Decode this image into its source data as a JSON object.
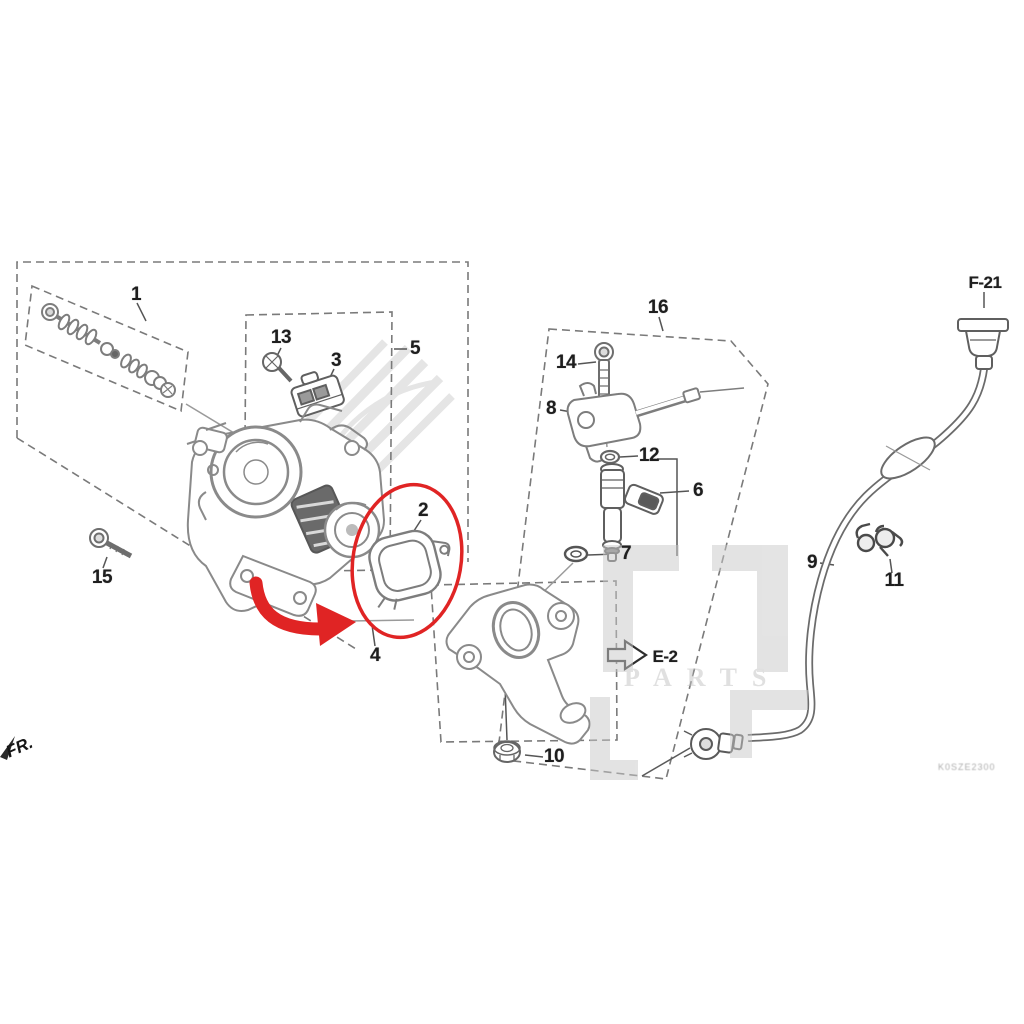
{
  "page": {
    "width": 1024,
    "height": 1024,
    "background": "#ffffff",
    "type": "exploded-parts-diagram",
    "subject": "throttle body / fuel injection assembly"
  },
  "colors": {
    "highlight_red": "#e02424",
    "line_gray": "#8a8a8a",
    "label_dark": "#1e1e1e",
    "watermark_gray": "#c9c9c9"
  },
  "part_labels": [
    {
      "text": "1",
      "x": 136,
      "y": 295
    },
    {
      "text": "2",
      "x": 423,
      "y": 511
    },
    {
      "text": "3",
      "x": 336,
      "y": 361
    },
    {
      "text": "4",
      "x": 375,
      "y": 656
    },
    {
      "text": "5",
      "x": 415,
      "y": 349
    },
    {
      "text": "6",
      "x": 698,
      "y": 491
    },
    {
      "text": "7",
      "x": 626,
      "y": 554
    },
    {
      "text": "8",
      "x": 551,
      "y": 409
    },
    {
      "text": "9",
      "x": 812,
      "y": 563
    },
    {
      "text": "10",
      "x": 554,
      "y": 757
    },
    {
      "text": "11",
      "x": 894,
      "y": 581
    },
    {
      "text": "12",
      "x": 649,
      "y": 456
    },
    {
      "text": "13",
      "x": 281,
      "y": 338
    },
    {
      "text": "14",
      "x": 566,
      "y": 363
    },
    {
      "text": "15",
      "x": 102,
      "y": 578
    },
    {
      "text": "16",
      "x": 658,
      "y": 308
    }
  ],
  "ref_labels": [
    {
      "text": "F-21",
      "x": 985,
      "y": 283
    },
    {
      "text": "E-2",
      "x": 665,
      "y": 657
    }
  ],
  "orientation_label": {
    "text": "FR.",
    "x": 3,
    "y": 744,
    "rotation_deg": -24
  },
  "watermark": {
    "brand_text": "PARTS"
  },
  "diagram_code": {
    "text": "K0SZE2300",
    "x": 938,
    "y": 762
  }
}
